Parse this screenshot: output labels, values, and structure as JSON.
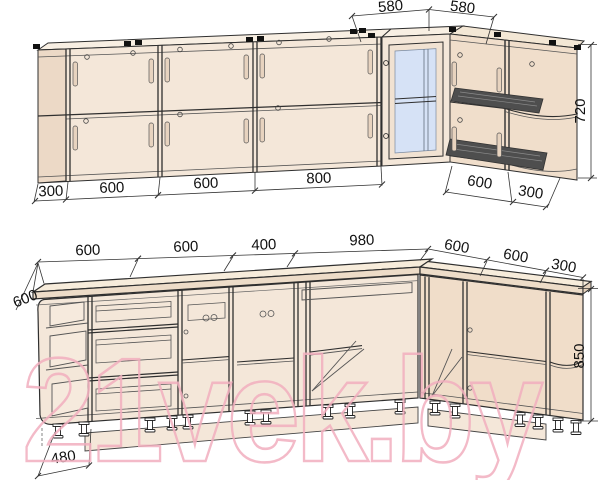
{
  "drawing": {
    "watermark_text": "21vek.by",
    "colors": {
      "line": "#2f2f2f",
      "cabinet_fill": "#f4e7d9",
      "cabinet_side_fill": "#ecd9c6",
      "countertop_fill": "#f7ecdb",
      "glass_fill": "#d6e2f6",
      "rack_fill": "#4e4e4e",
      "watermark_pink": "#f2afbf"
    },
    "upper_cabinets": {
      "corner_top_widths": [
        "580",
        "580"
      ],
      "bottom_widths": [
        "300",
        "600",
        "600",
        "800",
        "600",
        "300"
      ],
      "height": "720"
    },
    "base_cabinets": {
      "top_widths": [
        "600",
        "600",
        "400",
        "980",
        "600",
        "600",
        "300"
      ],
      "countertop_depth": "600",
      "plinth_inset": "480",
      "height": "850"
    }
  }
}
